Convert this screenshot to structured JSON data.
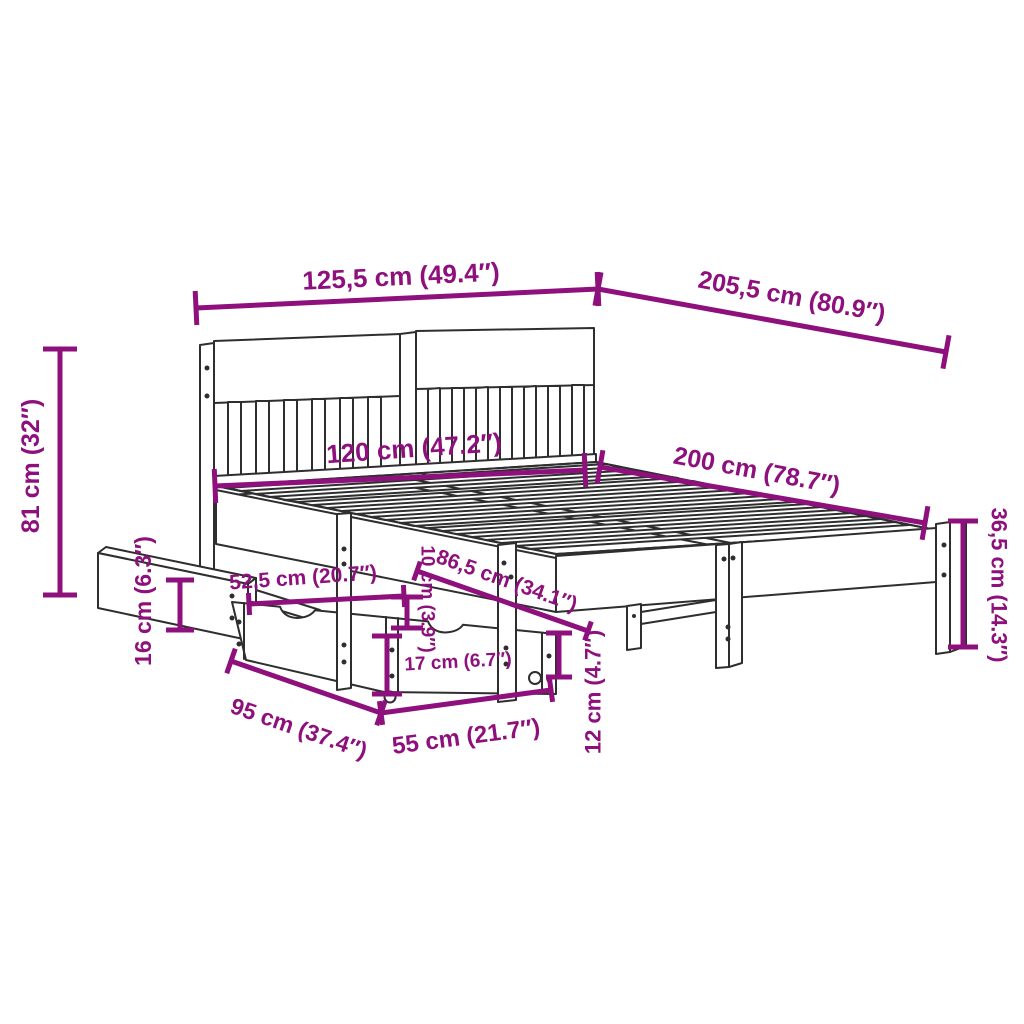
{
  "diagram": {
    "title": "bed-frame-with-storage-drawers-dimension-diagram",
    "canvas": {
      "width": 1024,
      "height": 1024,
      "background": "#ffffff"
    },
    "colors": {
      "dimension": "#8d107c",
      "line_art": "#2e2e2e"
    },
    "illustration": {
      "name": "bed-frame-line-art",
      "parts": [
        "headboard",
        "slatted-bed-base",
        "side-rail",
        "foot-legs",
        "storage-drawers",
        "pulled-out-drawer-panel",
        "caster-wheels"
      ]
    },
    "dimensions": [
      {
        "id": "overall-width",
        "label": "125,5 cm (49.4″)",
        "cm": 125.5,
        "inches": 49.4,
        "line": [
          196,
          308,
          598,
          289
        ],
        "tick": 17,
        "text": [
          401,
          276
        ],
        "rot": -2.7,
        "size": 26
      },
      {
        "id": "overall-length",
        "label": "205,5 cm (80.9″)",
        "cm": 205.5,
        "inches": 80.9,
        "line": [
          598,
          289,
          946,
          352
        ],
        "tick": 17,
        "text": [
          792,
          296
        ],
        "rot": 10.5,
        "size": 25
      },
      {
        "id": "headboard-height",
        "label": "81 cm (32″)",
        "cm": 81,
        "inches": 32,
        "line": [
          60,
          349,
          60,
          595
        ],
        "tick": 17,
        "text": [
          30,
          466
        ],
        "rot": -90,
        "size": 25
      },
      {
        "id": "base-width",
        "label": "120 cm (47.2″)",
        "cm": 120,
        "inches": 47.2,
        "line": [
          215,
          486,
          585,
          470
        ],
        "tick": 17,
        "text": [
          414,
          448
        ],
        "rot": -4,
        "size": 26
      },
      {
        "id": "base-length",
        "label": "200 cm (78.7″)",
        "cm": 200,
        "inches": 78.7,
        "line": [
          600,
          467,
          925,
          523
        ],
        "tick": 17,
        "text": [
          757,
          470
        ],
        "rot": 10.5,
        "size": 25
      },
      {
        "id": "foot-end-height",
        "label": "36,5 cm (14.3″)",
        "cm": 36.5,
        "inches": 14.3,
        "line": [
          963,
          521,
          963,
          647
        ],
        "tick": 15,
        "text": [
          999,
          585
        ],
        "rot": 90,
        "size": 22
      },
      {
        "id": "drawer-panel-height",
        "label": "16 cm (6.3″)",
        "cm": 16,
        "inches": 6.3,
        "line": [
          180,
          580,
          180,
          630
        ],
        "tick": 14,
        "text": [
          143,
          601
        ],
        "rot": -90,
        "size": 23
      },
      {
        "id": "drawer-top-depth",
        "label": "52,5 cm (20.7″)",
        "cm": 52.5,
        "inches": 20.7,
        "line": [
          249,
          604,
          404,
          596
        ],
        "tick": 11,
        "text": [
          303,
          577
        ],
        "rot": -4,
        "size": 21
      },
      {
        "id": "frame-clearance",
        "label": "10 cm (3.9″)",
        "cm": 10,
        "inches": 3.9,
        "line": [
          407,
          597,
          407,
          628
        ],
        "tick": 16,
        "text": [
          428,
          599
        ],
        "rot": 90,
        "size": 19
      },
      {
        "id": "under-bed-width",
        "label": "86,5 cm (34.1″)",
        "cm": 86.5,
        "inches": 34.1,
        "line": [
          417,
          571,
          588,
          631
        ],
        "tick": 10,
        "text": [
          507,
          580
        ],
        "rot": 19.5,
        "size": 21
      },
      {
        "id": "drawer-front-height",
        "label": "17 cm (6.7″)",
        "cm": 17,
        "inches": 6.7,
        "line": [
          387,
          636,
          387,
          694
        ],
        "tick": 15,
        "text": [
          458,
          661
        ],
        "rot": -3,
        "size": 19
      },
      {
        "id": "drawer-length",
        "label": "95 cm (37.4″)",
        "cm": 95,
        "inches": 37.4,
        "line": [
          231,
          661,
          381,
          713
        ],
        "tick": 13,
        "text": [
          299,
          728
        ],
        "rot": 19,
        "size": 23
      },
      {
        "id": "drawer-width",
        "label": "55 cm (21.7″)",
        "cm": 55,
        "inches": 21.7,
        "line": [
          381,
          713,
          551,
          690
        ],
        "tick": 12,
        "text": [
          466,
          736
        ],
        "rot": -7.5,
        "size": 24
      },
      {
        "id": "caster-clearance",
        "label": "12 cm (4.7″)",
        "cm": 12,
        "inches": 4.7,
        "line": [
          559,
          633,
          559,
          677
        ],
        "tick": 13,
        "text": [
          593,
          692
        ],
        "rot": -90,
        "size": 22
      }
    ]
  }
}
